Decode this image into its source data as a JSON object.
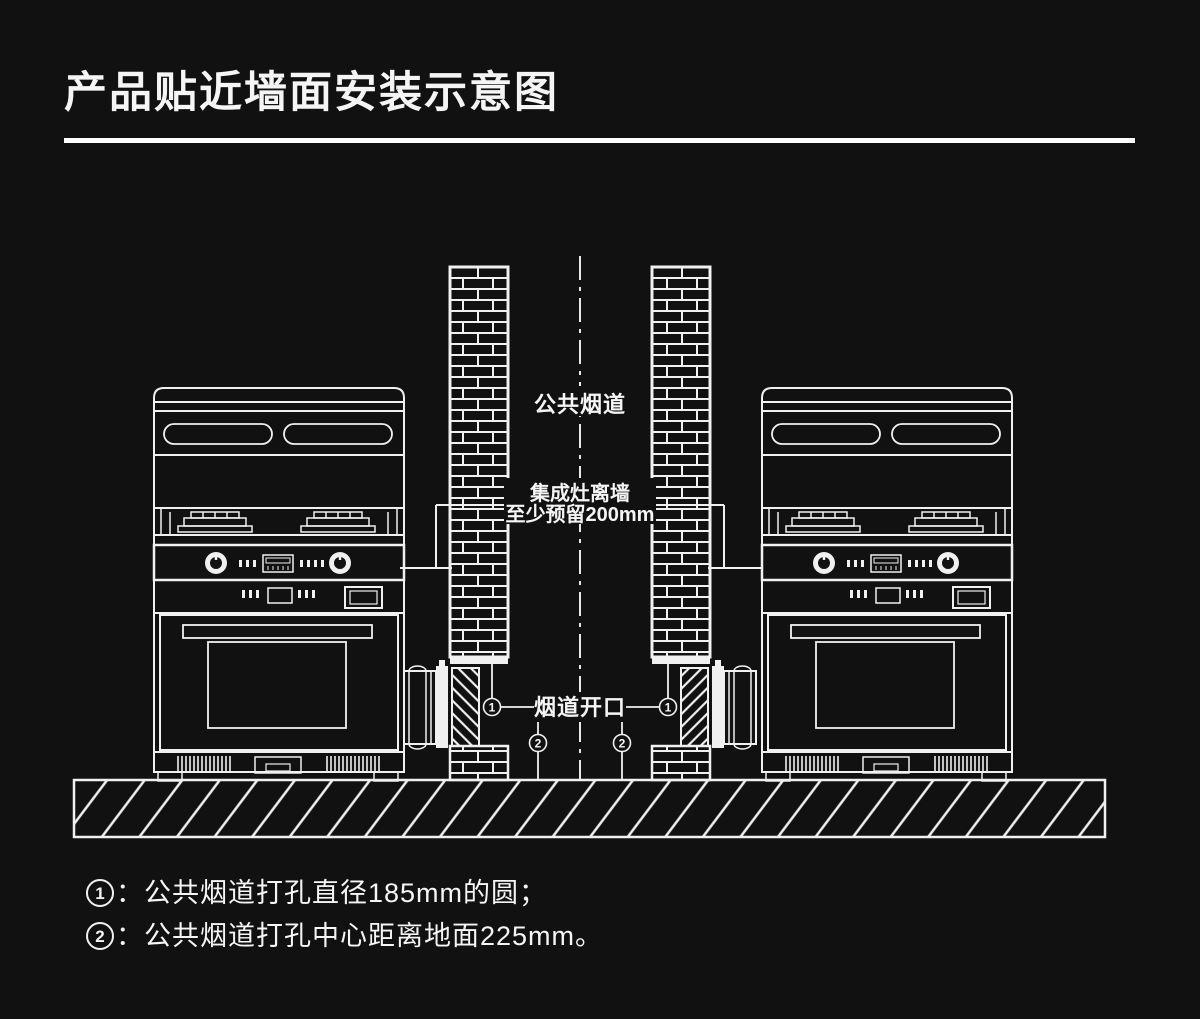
{
  "page": {
    "background": "#111111",
    "line_color": "#f0f0f0",
    "title": "产品贴近墙面安装示意图"
  },
  "diagram": {
    "flue_label": "公共烟道",
    "clearance_label_line1": "集成灶离墙",
    "clearance_label_line2": "至少预留200mm",
    "opening_label": "烟道开口",
    "marker_1": "1",
    "marker_2": "2"
  },
  "footnotes": [
    {
      "num": "1",
      "text": "：公共烟道打孔直径185mm的圆；"
    },
    {
      "num": "2",
      "text": "：公共烟道打孔中心距离地面225mm。"
    }
  ]
}
